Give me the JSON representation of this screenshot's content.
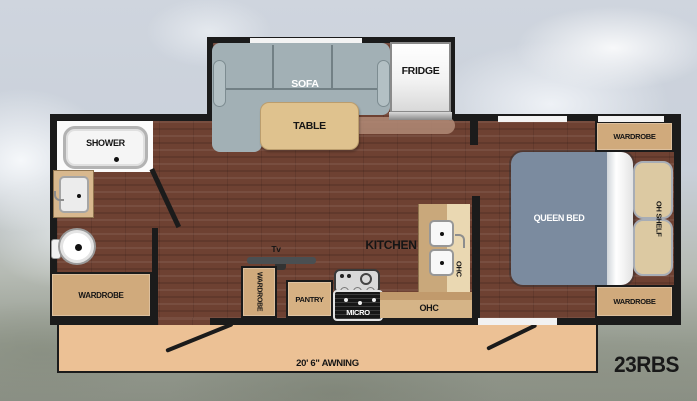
{
  "model_label": "23RBS",
  "exterior": {
    "awning_label": "20' 6\" AWNING"
  },
  "living_area": {
    "sofa_label": "SOFA",
    "table_label": "TABLE",
    "fridge_label": "FRIDGE",
    "tv_label": "Tv",
    "tv_wardrobe_label": "WARDROBE",
    "pantry_label": "PANTRY",
    "micro_label": "MICRO",
    "kitchen_label": "KITCHEN",
    "counter_ohc_label": "OHC",
    "sink_ohc_label": "OHC"
  },
  "bathroom": {
    "shower_label": "SHOWER",
    "wardrobe_label": "WARDROBE"
  },
  "bedroom": {
    "bed_label": "QUEEN BED",
    "oh_shelf_label": "OH SHELF",
    "wardrobe_top_label": "WARDROBE",
    "wardrobe_bottom_label": "WARDROBE"
  },
  "colors": {
    "wall": "#1b1b1b",
    "wood_floor": "#6e4132",
    "cabinet_tan": "#d0aa7c",
    "counter_tan": "#c9a87b",
    "counter_light_tan": "#ead8b2",
    "sofa_gray": "#a2b0b5",
    "bed_blue_gray": "#7b8b9f",
    "pillow_tan": "#dcc9a2",
    "awning_tan": "#ecc195"
  }
}
